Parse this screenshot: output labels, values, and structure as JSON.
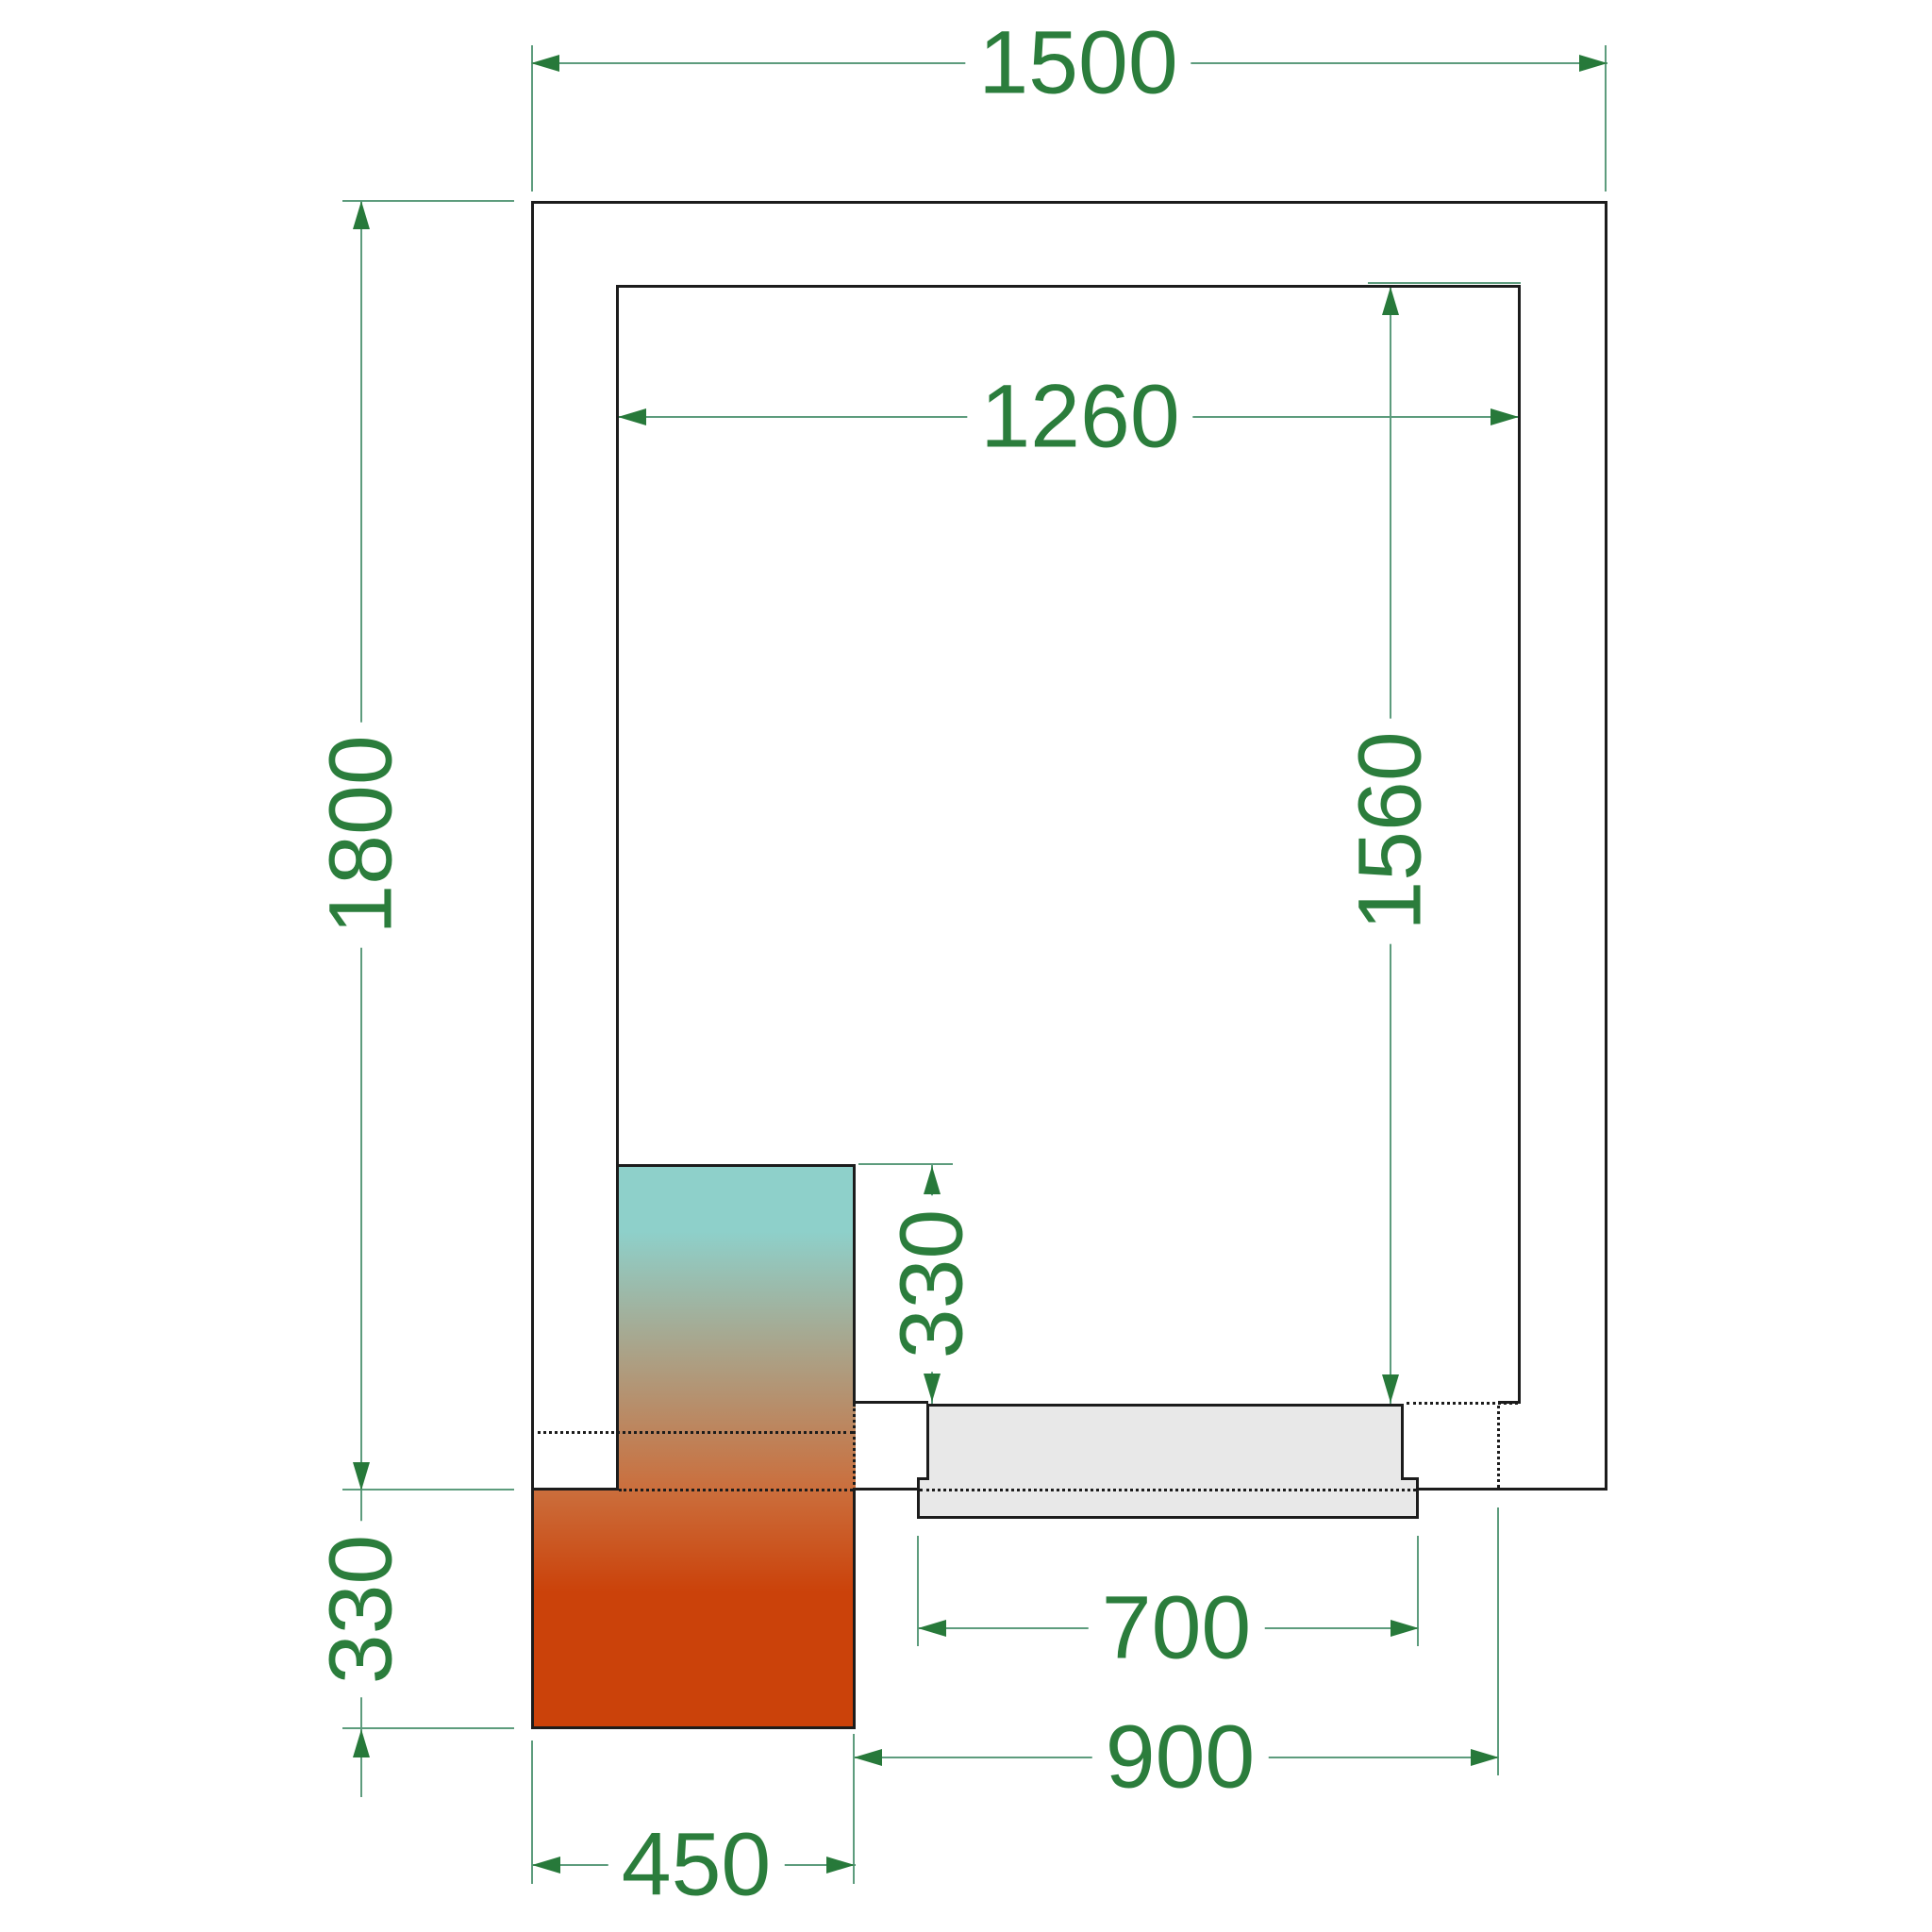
{
  "drawing": {
    "type": "cold-room-floor-plan",
    "dimension_labels": {
      "outer_width": "1500",
      "outer_depth": "1800",
      "inner_width": "1260",
      "inner_depth": "1560",
      "unit_protrusion_inside": "330",
      "unit_protrusion_outside": "330",
      "unit_width": "450",
      "door_width": "700",
      "door_clearance": "900"
    },
    "colors": {
      "dim_text": "#2b7d3c",
      "dim_line": "#5d9c7d",
      "arrow": "#27793a",
      "wall": "#1c1c1c",
      "door_fill": "#e8e8e8",
      "unit_cold": "#8ed0ca",
      "unit_mid": "#cb6e3c",
      "unit_hot": "#cb420a"
    }
  }
}
